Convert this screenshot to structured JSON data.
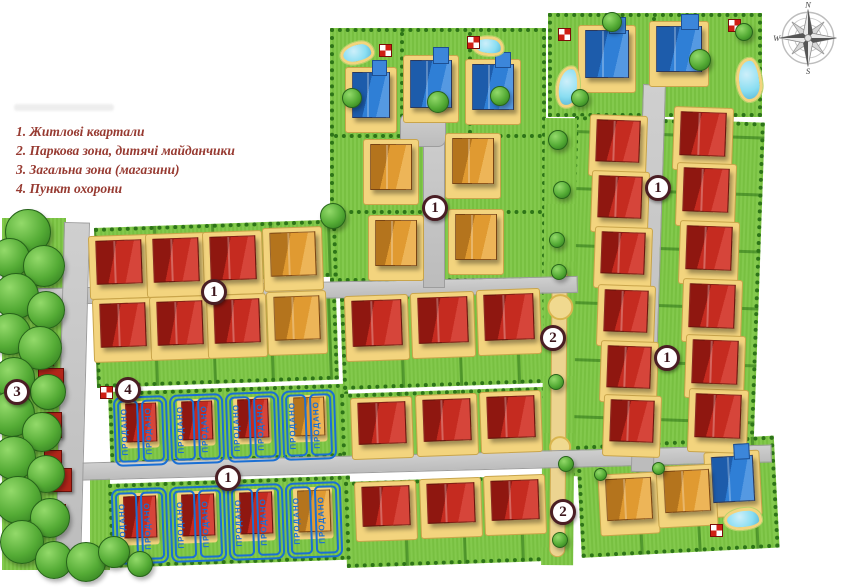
{
  "legend": {
    "items": [
      "1. Житлові квартали",
      "2. Паркова зона, дитячі майданчики",
      "3. Загальна зона (магазини)",
      "4. Пункт охорони"
    ]
  },
  "compass": {
    "north": "N",
    "west": "W",
    "south": "S"
  },
  "sold_label": "ПРОДАНО",
  "colors": {
    "sold_blue": "#1a6fd4",
    "house_red": "#c52b20",
    "house_orange": "#e09a31",
    "house_blue": "#2f7fd6",
    "grass": "#7cc643",
    "road": "#c6c6c6",
    "legend_text": "#973a31",
    "badge_ring": "#4a1e24"
  },
  "map": {
    "badges": [
      {
        "n": "1",
        "x": 435,
        "y": 208
      },
      {
        "n": "1",
        "x": 658,
        "y": 188
      },
      {
        "n": "1",
        "x": 214,
        "y": 292
      },
      {
        "n": "2",
        "x": 553,
        "y": 338
      },
      {
        "n": "1",
        "x": 667,
        "y": 358
      },
      {
        "n": "3",
        "x": 17,
        "y": 392
      },
      {
        "n": "4",
        "x": 128,
        "y": 390
      },
      {
        "n": "1",
        "x": 228,
        "y": 478
      },
      {
        "n": "2",
        "x": 563,
        "y": 512
      }
    ],
    "houses": [
      {
        "t": "blue",
        "x": 352,
        "y": 72,
        "w": 38,
        "h": 46,
        "r": 0
      },
      {
        "t": "blue",
        "x": 410,
        "y": 60,
        "w": 42,
        "h": 48,
        "r": 0
      },
      {
        "t": "blue",
        "x": 472,
        "y": 64,
        "w": 42,
        "h": 46,
        "r": 0
      },
      {
        "t": "blue",
        "x": 585,
        "y": 30,
        "w": 44,
        "h": 48,
        "r": 0
      },
      {
        "t": "blue",
        "x": 656,
        "y": 26,
        "w": 46,
        "h": 46,
        "r": 0
      },
      {
        "t": "blue",
        "x": 712,
        "y": 456,
        "w": 42,
        "h": 46,
        "r": -3
      },
      {
        "t": "orange",
        "x": 370,
        "y": 144,
        "w": 42,
        "h": 46,
        "r": 0
      },
      {
        "t": "orange",
        "x": 452,
        "y": 138,
        "w": 42,
        "h": 46,
        "r": 0
      },
      {
        "t": "orange",
        "x": 375,
        "y": 220,
        "w": 42,
        "h": 46,
        "r": 0
      },
      {
        "t": "orange",
        "x": 455,
        "y": 214,
        "w": 42,
        "h": 46,
        "r": 0
      },
      {
        "t": "orange",
        "x": 270,
        "y": 232,
        "w": 46,
        "h": 44,
        "r": -2
      },
      {
        "t": "orange",
        "x": 274,
        "y": 296,
        "w": 46,
        "h": 44,
        "r": -2
      },
      {
        "t": "orange",
        "x": 606,
        "y": 478,
        "w": 46,
        "h": 42,
        "r": -3
      },
      {
        "t": "orange",
        "x": 664,
        "y": 470,
        "w": 46,
        "h": 42,
        "r": -3
      },
      {
        "t": "red",
        "x": 96,
        "y": 240,
        "w": 46,
        "h": 44,
        "r": -2
      },
      {
        "t": "red",
        "x": 153,
        "y": 238,
        "w": 46,
        "h": 44,
        "r": -2
      },
      {
        "t": "red",
        "x": 210,
        "y": 236,
        "w": 46,
        "h": 44,
        "r": -2
      },
      {
        "t": "red",
        "x": 100,
        "y": 303,
        "w": 46,
        "h": 44,
        "r": -2
      },
      {
        "t": "red",
        "x": 157,
        "y": 301,
        "w": 46,
        "h": 44,
        "r": -2
      },
      {
        "t": "red",
        "x": 214,
        "y": 299,
        "w": 46,
        "h": 44,
        "r": -2
      },
      {
        "t": "red",
        "x": 352,
        "y": 300,
        "w": 50,
        "h": 46,
        "r": -2
      },
      {
        "t": "red",
        "x": 418,
        "y": 297,
        "w": 50,
        "h": 46,
        "r": -2
      },
      {
        "t": "red",
        "x": 484,
        "y": 294,
        "w": 50,
        "h": 46,
        "r": -2
      },
      {
        "t": "red",
        "x": 358,
        "y": 402,
        "w": 48,
        "h": 42,
        "r": -2
      },
      {
        "t": "red",
        "x": 423,
        "y": 399,
        "w": 48,
        "h": 42,
        "r": -2
      },
      {
        "t": "red",
        "x": 487,
        "y": 396,
        "w": 48,
        "h": 42,
        "r": -2
      },
      {
        "t": "red",
        "x": 362,
        "y": 486,
        "w": 48,
        "h": 40,
        "r": -2
      },
      {
        "t": "red",
        "x": 427,
        "y": 483,
        "w": 48,
        "h": 40,
        "r": -2
      },
      {
        "t": "red",
        "x": 491,
        "y": 480,
        "w": 48,
        "h": 40,
        "r": -2
      },
      {
        "t": "red",
        "x": 596,
        "y": 120,
        "w": 44,
        "h": 42,
        "r": 2
      },
      {
        "t": "red",
        "x": 598,
        "y": 176,
        "w": 44,
        "h": 42,
        "r": 2
      },
      {
        "t": "red",
        "x": 601,
        "y": 232,
        "w": 44,
        "h": 42,
        "r": 2
      },
      {
        "t": "red",
        "x": 604,
        "y": 290,
        "w": 44,
        "h": 42,
        "r": 2
      },
      {
        "t": "red",
        "x": 607,
        "y": 346,
        "w": 44,
        "h": 42,
        "r": 2
      },
      {
        "t": "red",
        "x": 610,
        "y": 400,
        "w": 44,
        "h": 42,
        "r": 2
      },
      {
        "t": "red",
        "x": 680,
        "y": 112,
        "w": 46,
        "h": 44,
        "r": 2
      },
      {
        "t": "red",
        "x": 683,
        "y": 168,
        "w": 46,
        "h": 44,
        "r": 2
      },
      {
        "t": "red",
        "x": 686,
        "y": 226,
        "w": 46,
        "h": 44,
        "r": 2
      },
      {
        "t": "red",
        "x": 689,
        "y": 284,
        "w": 46,
        "h": 44,
        "r": 2
      },
      {
        "t": "red",
        "x": 692,
        "y": 340,
        "w": 46,
        "h": 44,
        "r": 2
      },
      {
        "t": "red",
        "x": 695,
        "y": 394,
        "w": 46,
        "h": 44,
        "r": 2
      },
      {
        "t": "shop",
        "x": 34,
        "y": 350,
        "w": 20,
        "h": 16,
        "r": 0
      },
      {
        "t": "shop",
        "x": 38,
        "y": 368,
        "w": 26,
        "h": 20,
        "r": 0
      },
      {
        "t": "shop",
        "x": 40,
        "y": 412,
        "w": 22,
        "h": 26,
        "r": 0
      },
      {
        "t": "shop",
        "x": 44,
        "y": 450,
        "w": 18,
        "h": 14,
        "r": 0
      },
      {
        "t": "shop",
        "x": 46,
        "y": 468,
        "w": 26,
        "h": 24,
        "r": 0
      },
      {
        "t": "shop",
        "x": 50,
        "y": 504,
        "w": 16,
        "h": 14,
        "r": 0
      }
    ],
    "sold_lots": [
      {
        "x": 114,
        "y": 396,
        "w": 54,
        "h": 70,
        "r": -2,
        "house": "red"
      },
      {
        "x": 170,
        "y": 394,
        "w": 54,
        "h": 70,
        "r": -2,
        "house": "red"
      },
      {
        "x": 226,
        "y": 392,
        "w": 54,
        "h": 70,
        "r": -2,
        "house": "red"
      },
      {
        "x": 282,
        "y": 390,
        "w": 54,
        "h": 70,
        "r": -2,
        "house": "orange"
      },
      {
        "x": 112,
        "y": 488,
        "w": 56,
        "h": 76,
        "r": -2,
        "house": "red"
      },
      {
        "x": 170,
        "y": 486,
        "w": 56,
        "h": 76,
        "r": -2,
        "house": "red"
      },
      {
        "x": 228,
        "y": 484,
        "w": 56,
        "h": 76,
        "r": -2,
        "house": "red"
      },
      {
        "x": 286,
        "y": 482,
        "w": 56,
        "h": 76,
        "r": -2,
        "house": "orange"
      }
    ],
    "trees": [
      {
        "x": 28,
        "y": 232,
        "d": 46
      },
      {
        "x": 10,
        "y": 258,
        "d": 40
      },
      {
        "x": 44,
        "y": 266,
        "d": 42
      },
      {
        "x": 16,
        "y": 296,
        "d": 46
      },
      {
        "x": 46,
        "y": 310,
        "d": 38
      },
      {
        "x": 10,
        "y": 334,
        "d": 42
      },
      {
        "x": 40,
        "y": 348,
        "d": 44
      },
      {
        "x": 14,
        "y": 378,
        "d": 42
      },
      {
        "x": 48,
        "y": 392,
        "d": 36
      },
      {
        "x": 12,
        "y": 414,
        "d": 46
      },
      {
        "x": 42,
        "y": 432,
        "d": 40
      },
      {
        "x": 14,
        "y": 458,
        "d": 44
      },
      {
        "x": 46,
        "y": 474,
        "d": 38
      },
      {
        "x": 18,
        "y": 500,
        "d": 48
      },
      {
        "x": 50,
        "y": 518,
        "d": 40
      },
      {
        "x": 22,
        "y": 542,
        "d": 44
      },
      {
        "x": 54,
        "y": 560,
        "d": 38
      },
      {
        "x": 86,
        "y": 562,
        "d": 40
      },
      {
        "x": 114,
        "y": 552,
        "d": 32
      },
      {
        "x": 140,
        "y": 564,
        "d": 26
      },
      {
        "x": 333,
        "y": 216,
        "d": 26
      },
      {
        "x": 352,
        "y": 98,
        "d": 20
      },
      {
        "x": 438,
        "y": 102,
        "d": 22
      },
      {
        "x": 500,
        "y": 96,
        "d": 20
      },
      {
        "x": 612,
        "y": 22,
        "d": 20
      },
      {
        "x": 700,
        "y": 60,
        "d": 22
      },
      {
        "x": 580,
        "y": 98,
        "d": 18
      },
      {
        "x": 744,
        "y": 32,
        "d": 18
      },
      {
        "x": 558,
        "y": 140,
        "d": 20
      },
      {
        "x": 562,
        "y": 190,
        "d": 18
      },
      {
        "x": 557,
        "y": 240,
        "d": 16
      },
      {
        "x": 559,
        "y": 272,
        "d": 16
      },
      {
        "x": 556,
        "y": 382,
        "d": 16
      },
      {
        "x": 566,
        "y": 464,
        "d": 16
      },
      {
        "x": 560,
        "y": 540,
        "d": 16
      },
      {
        "x": 600,
        "y": 474,
        "d": 13
      },
      {
        "x": 658,
        "y": 468,
        "d": 13
      }
    ],
    "ponds": [
      {
        "x": 340,
        "y": 42,
        "w": 34,
        "h": 22,
        "r": -12
      },
      {
        "x": 472,
        "y": 36,
        "w": 32,
        "h": 20,
        "r": 8
      },
      {
        "x": 556,
        "y": 66,
        "w": 24,
        "h": 42,
        "r": 6
      },
      {
        "x": 736,
        "y": 58,
        "w": 26,
        "h": 44,
        "r": -6
      },
      {
        "x": 724,
        "y": 508,
        "w": 38,
        "h": 22,
        "r": -4
      }
    ],
    "checkers": [
      {
        "x": 379,
        "y": 44
      },
      {
        "x": 467,
        "y": 36
      },
      {
        "x": 558,
        "y": 28
      },
      {
        "x": 728,
        "y": 19
      },
      {
        "x": 100,
        "y": 386
      },
      {
        "x": 710,
        "y": 524
      }
    ]
  }
}
